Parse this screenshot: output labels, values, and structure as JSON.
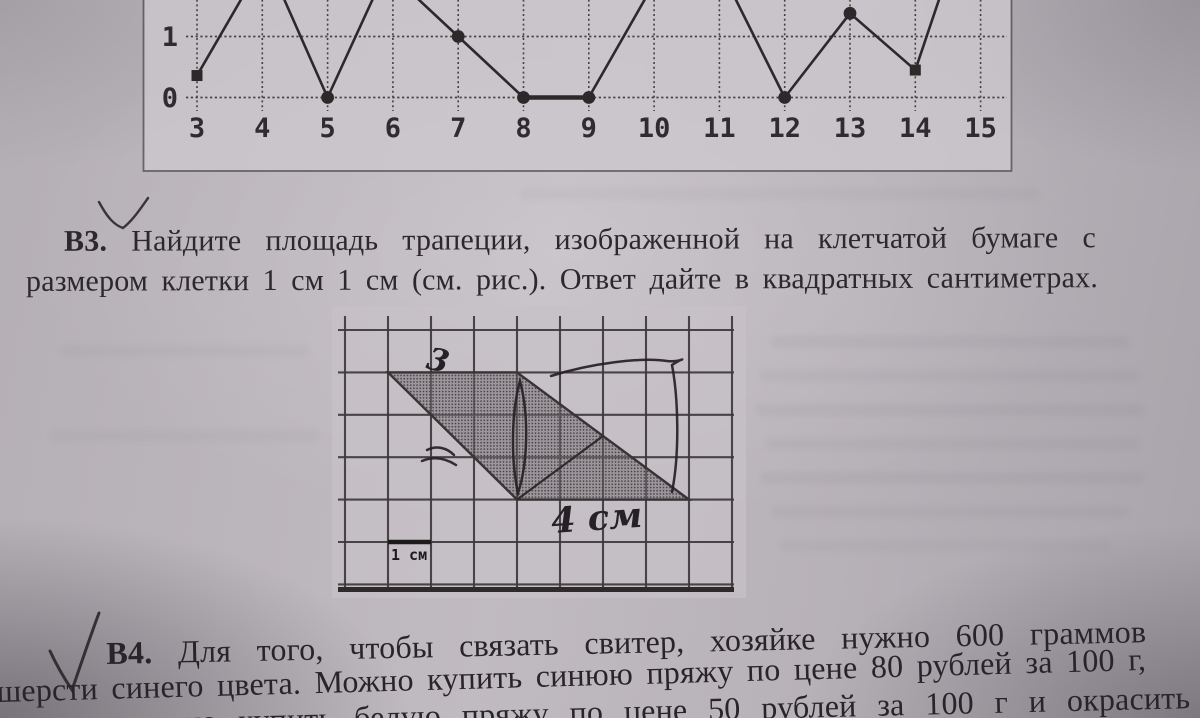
{
  "page": {
    "kind": "photographed textbook page",
    "language": "ru",
    "subject": "mathematics exam problems"
  },
  "chart_data": {
    "type": "line",
    "title": "",
    "xlabel": "",
    "ylabel": "",
    "x_ticks": [
      3,
      4,
      5,
      6,
      7,
      8,
      9,
      10,
      11,
      12,
      13,
      14,
      15
    ],
    "y_ticks": [
      {
        "label": "1",
        "value": 1
      },
      {
        "label": "0",
        "value": 0
      }
    ],
    "xlim": [
      2.3,
      15.7
    ],
    "grid": "dotted",
    "legend": "none",
    "notes": "top of the chart is cropped off by the photo edge; peaks between labeled points run off-screen",
    "series": [
      {
        "name": "graph",
        "visible_points": [
          [
            3,
            0.36
          ],
          [
            5,
            0
          ],
          [
            7,
            1
          ],
          [
            8,
            0
          ],
          [
            9,
            0
          ],
          [
            12,
            0
          ],
          [
            13,
            1.38
          ],
          [
            14,
            0.45
          ]
        ],
        "marker_by_x": {
          "3": "square",
          "5": "circle",
          "7": "circle",
          "8": "circle",
          "9": "circle",
          "12": "circle",
          "13": "circle",
          "14": "square"
        },
        "path_with_offscreen_peaks": [
          [
            3,
            0.36
          ],
          [
            4.05,
            2.3
          ],
          [
            5,
            0
          ],
          [
            5.9,
            2.1
          ],
          [
            7,
            1
          ],
          [
            8,
            0
          ],
          [
            9,
            0
          ],
          [
            10.6,
            3.0
          ],
          [
            12,
            0
          ],
          [
            13,
            1.38
          ],
          [
            14,
            0.45
          ],
          [
            14.55,
            2.2
          ]
        ],
        "flat_thick_segment": [
          [
            8,
            0
          ],
          [
            9,
            0
          ]
        ]
      }
    ]
  },
  "problems": {
    "b3": {
      "label": "В3.",
      "line1": "Найдите площадь трапеции, изображенной на клетчатой бумаге с",
      "line2": "размером клетки 1 см  1 см (см. рис.). Ответ дайте в квадратных сантиметрах."
    },
    "b4": {
      "label": "В4.",
      "line1": "Для  того,  чтобы  связать  свитер,  хозяйке  нужно  600  граммов",
      "line2": "шерсти синего цвета. Можно купить синюю пряжу по цене 80 рублей за 100 г,",
      "line3": "а можно купить белую пряжу по цене 50 рублей за 100 г и окрасить",
      "line3_clipped": true
    }
  },
  "figure": {
    "grid_cols": 9,
    "grid_rows": 6,
    "scale_label": "1 см",
    "shape": "trapezoid",
    "vertices_cells": [
      [
        1,
        1
      ],
      [
        4,
        1
      ],
      [
        8,
        4
      ],
      [
        4,
        4
      ]
    ],
    "inner_segment_cells": [
      [
        4,
        4
      ],
      [
        6,
        2.5
      ]
    ],
    "handwritten_top_label": "3",
    "handwritten_bottom_label": "4 см",
    "pen_annotations": [
      "vertical height stroke",
      "loop around right side",
      "small squiggle arrow on left leg",
      "checkmark under chart",
      "checkmark beside B4"
    ]
  },
  "colors": {
    "page": "#bab5bb",
    "ink": "#2b272b",
    "pen": "#262124",
    "chart_background": "#ccc8cd",
    "grid_line": "#3e3a3b",
    "trapezoid_fill": "#8f898d"
  }
}
